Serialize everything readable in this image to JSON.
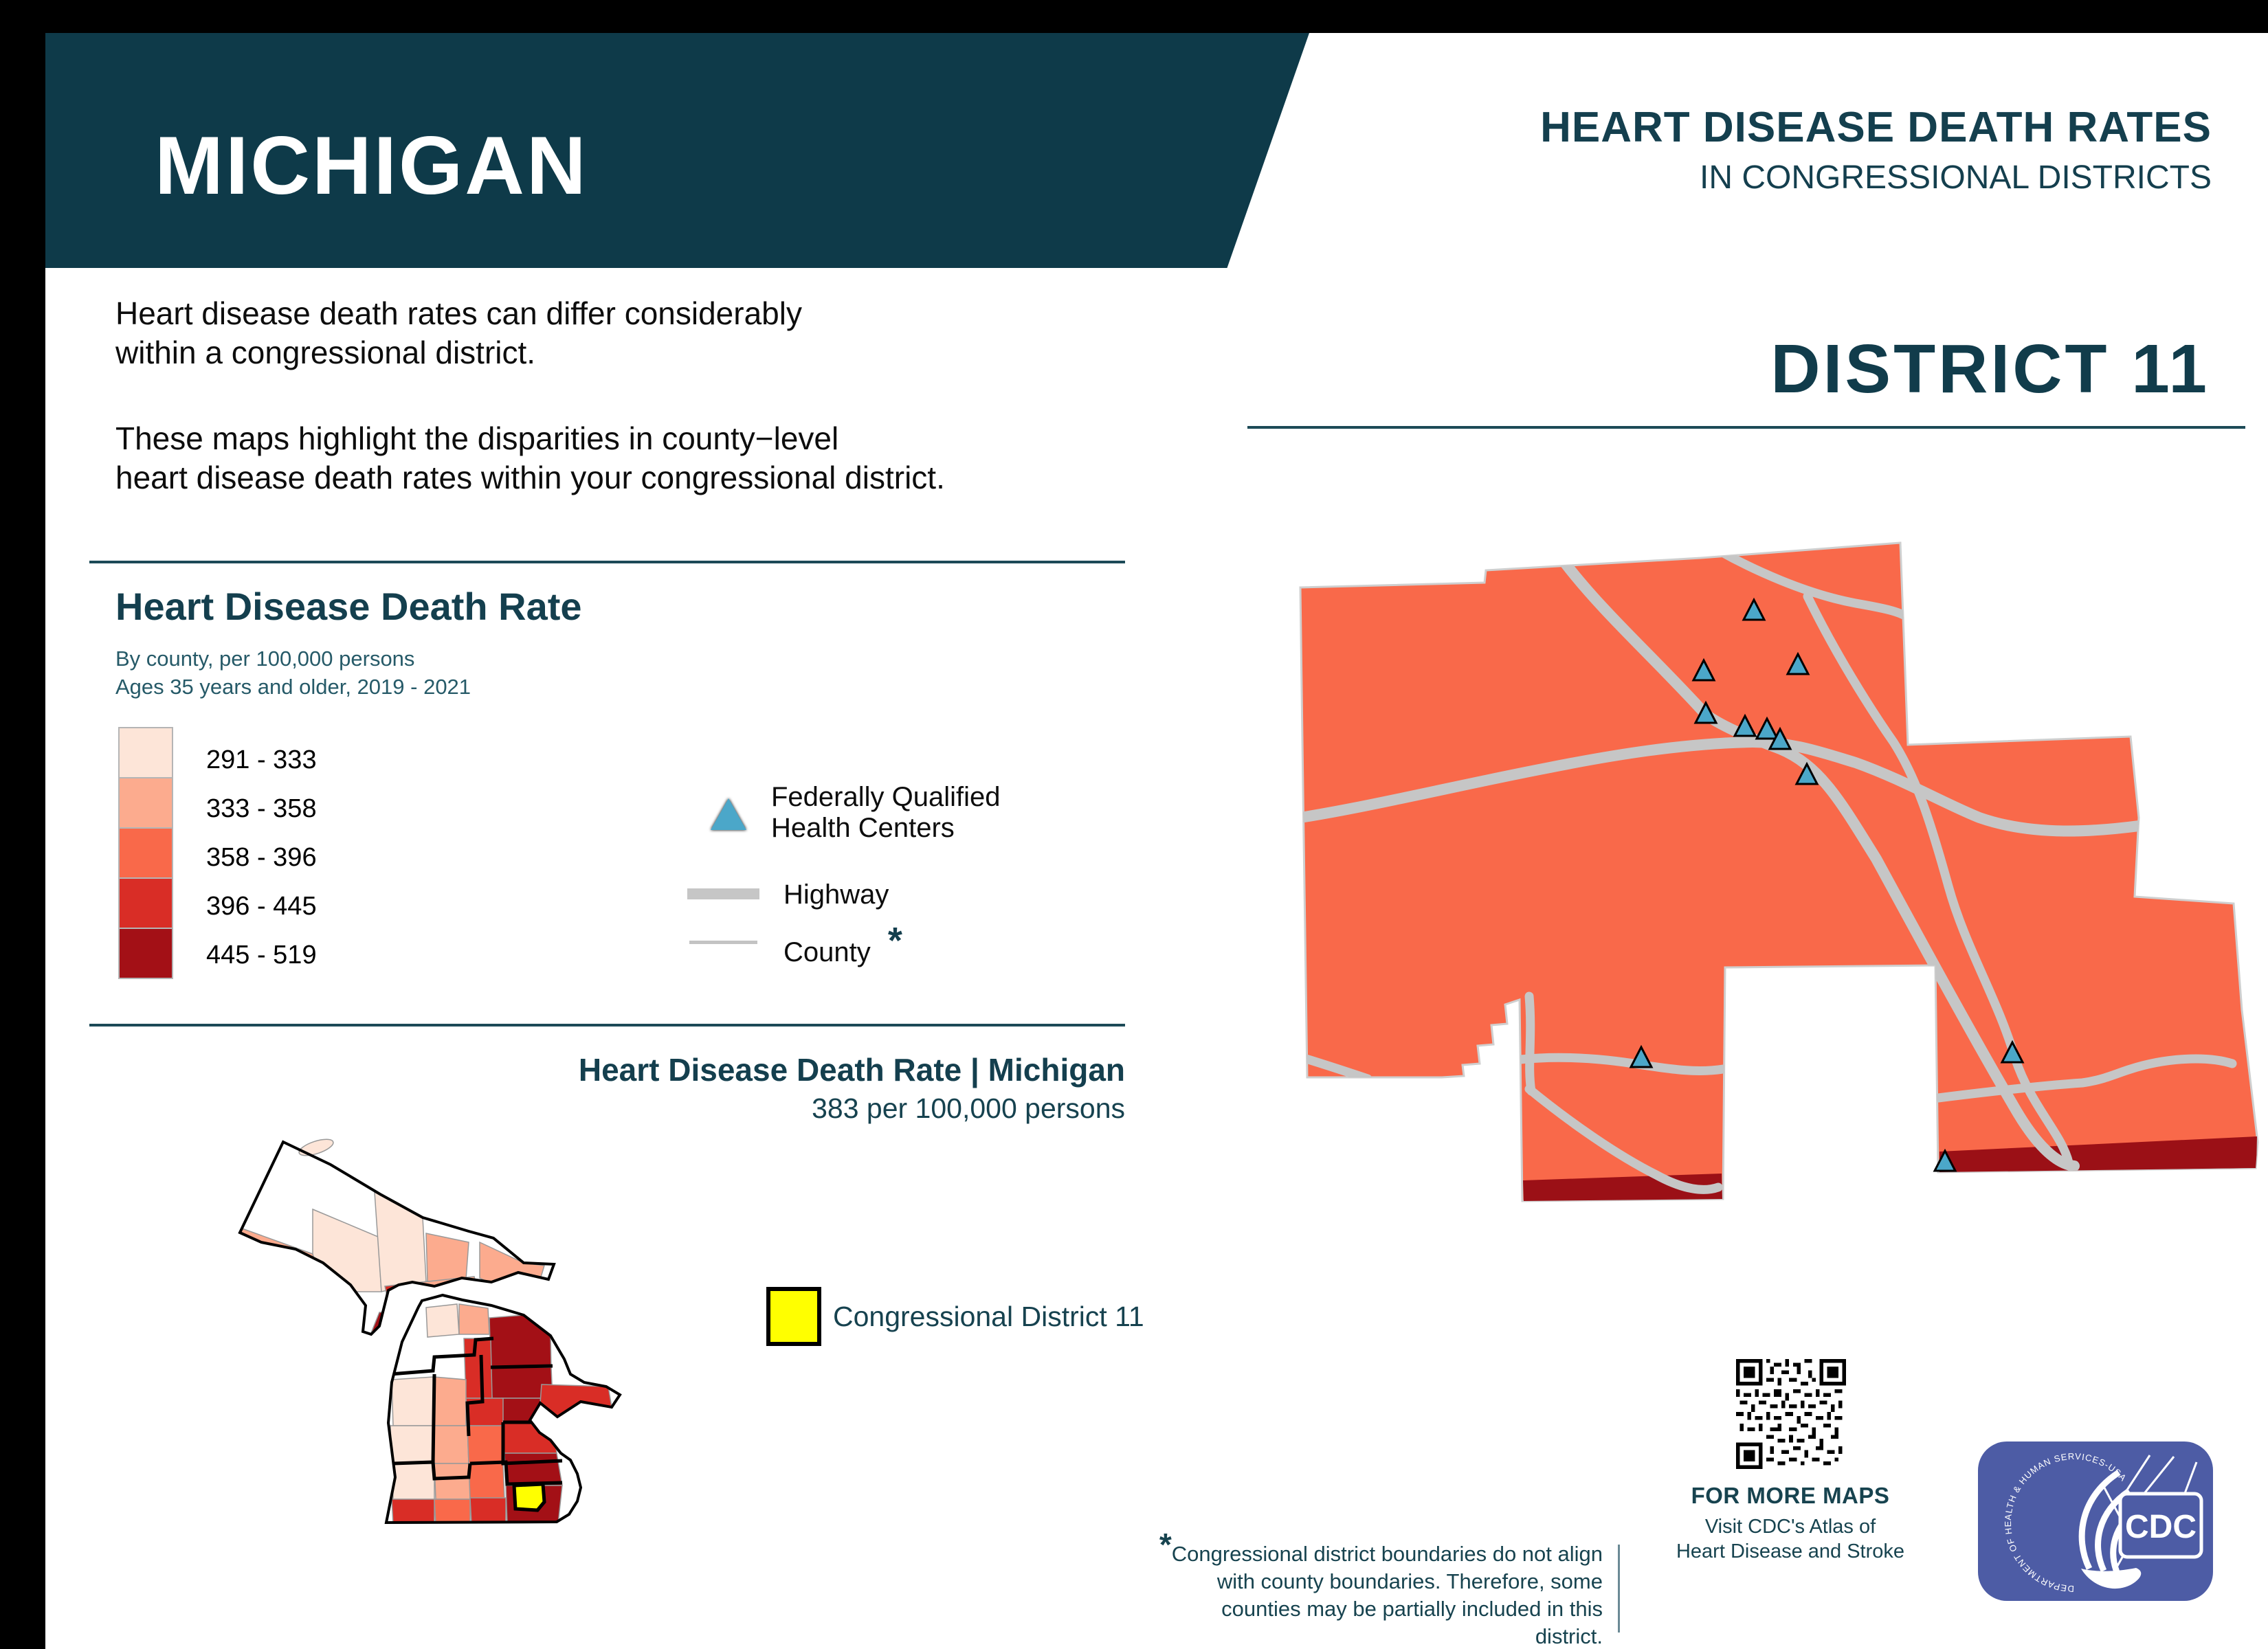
{
  "header": {
    "state_name": "MICHIGAN",
    "title_line1": "HEART DISEASE DEATH RATES",
    "title_line2": "IN CONGRESSIONAL DISTRICTS",
    "district_title": "DISTRICT  11"
  },
  "intro": {
    "para1_line1": "Heart disease death rates can differ considerably",
    "para1_line2": "within a congressional district.",
    "para2_line1": "These maps highlight the disparities in county−level",
    "para2_line2": "heart disease death rates within your congressional district."
  },
  "legend": {
    "title": "Heart Disease Death Rate",
    "subtitle_line1": "By county, per 100,000 persons",
    "subtitle_line2": "Ages 35 years and older, 2019 - 2021",
    "classes": [
      {
        "range": "291 - 333",
        "color": "#fde5d8"
      },
      {
        "range": "333 - 358",
        "color": "#fcab8e"
      },
      {
        "range": "358 - 396",
        "color": "#f9694a"
      },
      {
        "range": "396 - 445",
        "color": "#d92d26"
      },
      {
        "range": "445 - 519",
        "color": "#a31016"
      }
    ],
    "fqhc_line1": "Federally Qualified",
    "fqhc_line2": "Health Centers",
    "highway_label": "Highway",
    "county_label": "County",
    "county_footnote_mark": "*"
  },
  "state_summary": {
    "title": "Heart Disease Death Rate | Michigan",
    "value": "383 per 100,000 persons",
    "district_legend_label": "Congressional District 11"
  },
  "footnote": {
    "mark": "*",
    "line1": "Congressional district boundaries do not align",
    "line2": "with county boundaries. Therefore, some",
    "line3": "counties may be partially included in this district."
  },
  "footer": {
    "more_maps_title": "FOR MORE MAPS",
    "more_maps_line1": "Visit CDC's Atlas of",
    "more_maps_line2": "Heart Disease and Stroke"
  },
  "logo": {
    "ring_text": "DEPARTMENT OF HEALTH & HUMAN SERVICES-USA",
    "cdc_text": "CDC"
  },
  "colors": {
    "banner_teal": "#0e3a49",
    "heading_teal": "#143f4e",
    "rule_teal": "#1c4a57",
    "district_fill": "#f9694a",
    "district_stroke": "#cfcfcf",
    "highway_gray": "#c6c6c6",
    "county_gray": "#c3c3c3",
    "dark_red_strip": "#9b1016",
    "fqhc_triangle": "#4ba7c9",
    "district11_yellow": "#ffff00",
    "logo_blue": "#4d5ca5"
  },
  "district_map": {
    "fqhc_count": 11
  }
}
